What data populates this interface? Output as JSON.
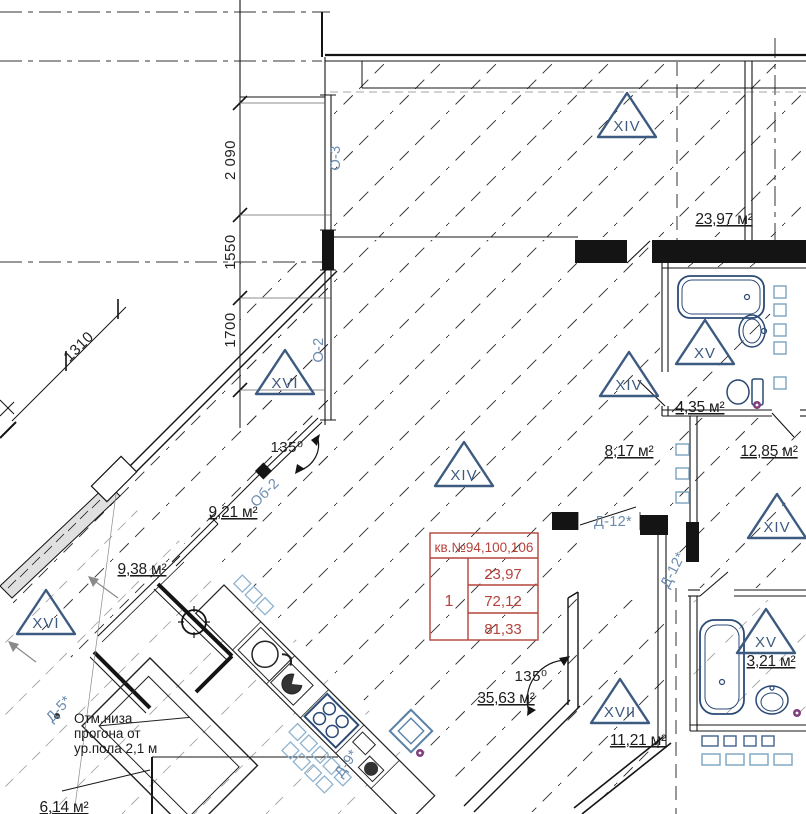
{
  "colors": {
    "line": "#141414",
    "marker_blue": "#3d5a80",
    "label_blue": "#6b8bae",
    "fixture_blue": "#2b4a75",
    "light_blue": "#7ba3bf",
    "table_red": "#b5433c",
    "purple": "#82407f"
  },
  "dims": {
    "v1": "2 090",
    "v2": "1550",
    "v3": "1700",
    "diag": "1310",
    "angle_a": "135⁰",
    "angle_b": "135⁰"
  },
  "labels": {
    "o3": "О-3",
    "o2": "О-2",
    "ob2": "Об-2",
    "d12a": "Д-12*",
    "d12b": "Д-12*",
    "d5": "Д-5*",
    "d9": "Д-9*"
  },
  "markers": {
    "xiv_top": "XIV",
    "xiv_center": "XIV",
    "xiv_mid_right": "XIV",
    "xiv_far_right": "XIV",
    "xv_bath_top": "XV",
    "xv_bath_bottom": "XV",
    "xvi_upper": "XVI",
    "xvi_lower": "XVI",
    "xvii": "XVII"
  },
  "areas": {
    "a2397": "23,97 м²",
    "a435": "4,35 м²",
    "a1285": "12,85 м²",
    "a817": "8,17 м²",
    "a921": "9,21 м²",
    "a938": "9,38 м²",
    "a3563": "35,63 м²",
    "a1121": "11,21 м²",
    "a321": "3,21 м²",
    "a614": "6,14 м²"
  },
  "apartment_table": {
    "header": "кв.№94,100,106",
    "unit": "1",
    "r1": "23,97",
    "r2": "72,12",
    "r3": "81,33"
  },
  "note": {
    "l1": "Отм.низа",
    "l2": "прогона от",
    "l3": "ур.пола 2,1 м"
  }
}
